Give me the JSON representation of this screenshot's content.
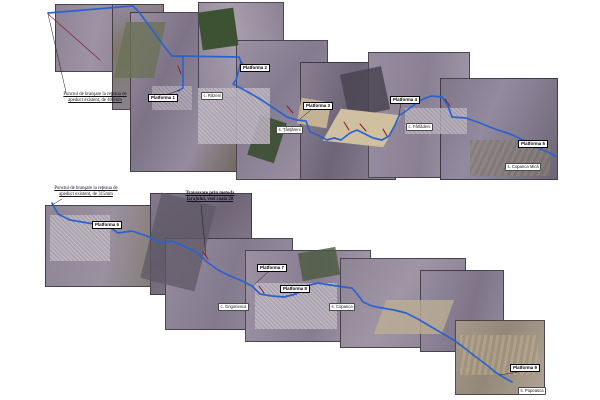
{
  "document": {
    "type": "scanned pipeline route plan on aerial photo mosaic",
    "background": "#ffffff"
  },
  "colors": {
    "route": "#2b62d0",
    "marker": "#8a1826",
    "leader": "#1c1a22",
    "label_bg": "#ffffff",
    "label_border": "#000000"
  },
  "top_map": {
    "start_note": {
      "line1": "Punctul de branşare la reţeaua de",
      "line2": "apeduct existent, de 400mm"
    },
    "platforms": [
      "Platforma 1",
      "Platforma 2",
      "Platforma 3",
      "Platforma 4",
      "Platforma 5"
    ],
    "villages": [
      "c. Răzeni",
      "s. Ţânţăreni",
      "c. Fârlădeni",
      "s. Copanca Mică"
    ]
  },
  "bottom_map": {
    "start_note": {
      "line1": "Punctul de branşare la reţeaua de",
      "line2": "apeduct existent, de 315mm"
    },
    "crossing_note": {
      "line1": "Traversare prin metoda",
      "line2": "forajului, vezi coala 20"
    },
    "platforms": [
      "Platforma 6",
      "Platforma 7",
      "Platforma 8",
      "Platforma 9"
    ],
    "villages": [
      "c. Grigorievca",
      "s. Copanca",
      "s. Popeasca"
    ]
  }
}
